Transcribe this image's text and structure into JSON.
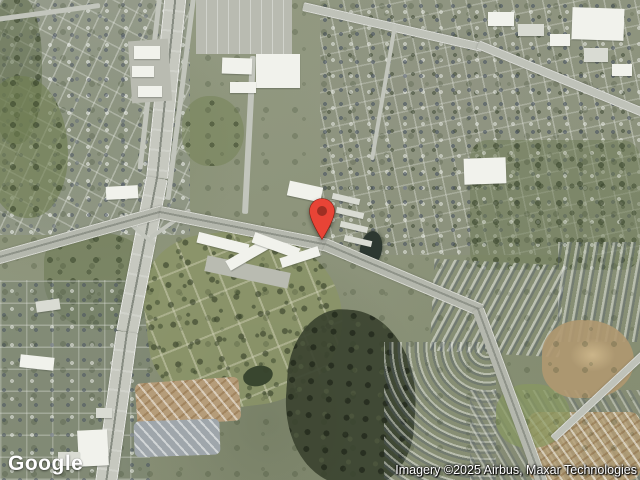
{
  "map": {
    "logo_text": "Google",
    "attribution": "Imagery ©2025 Airbus, Maxar Technologies",
    "marker": {
      "icon": "map-pin-icon",
      "color": "#E84436",
      "inner_color": "#9E2F23",
      "outline_color": "#7E1D12"
    }
  }
}
